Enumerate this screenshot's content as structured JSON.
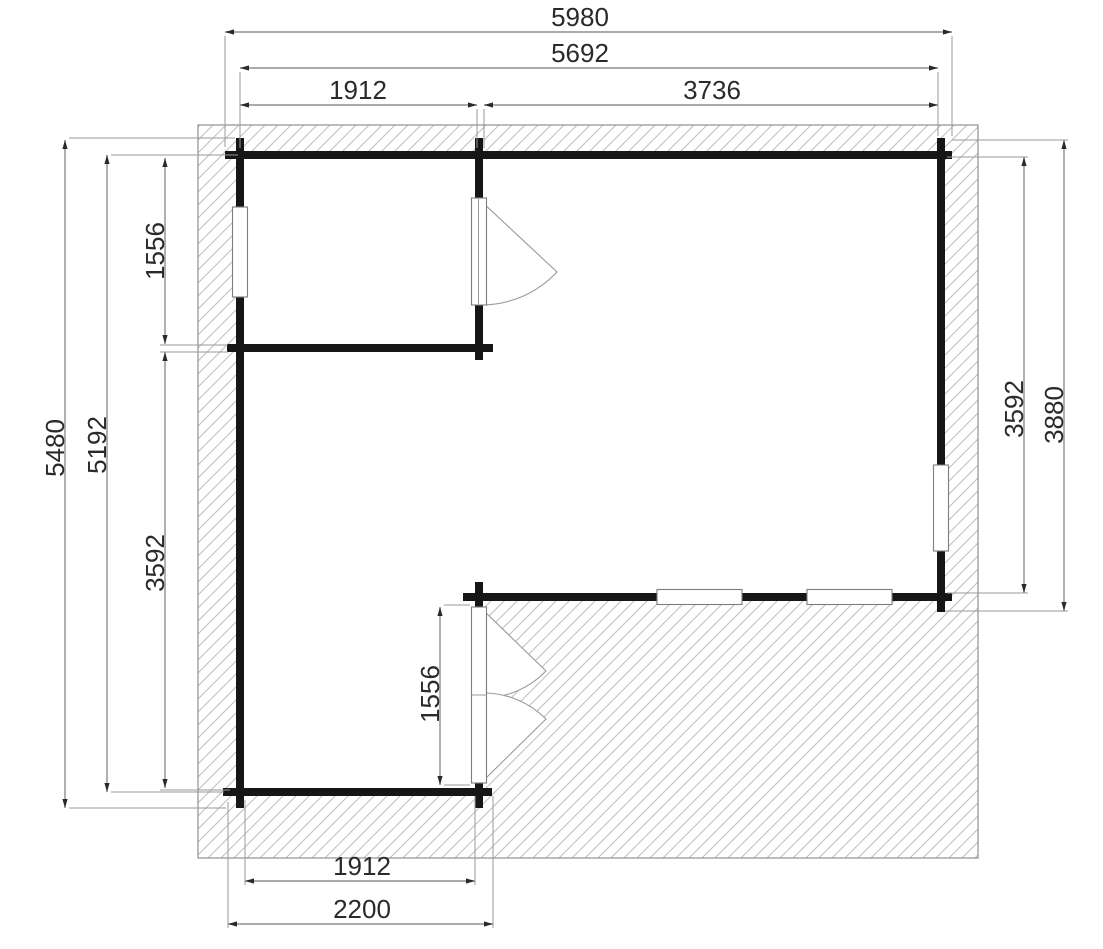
{
  "document": {
    "type": "architectural-floor-plan",
    "description": "Garden house floor plan with roof overhang, interior room partitions, windows, doors and terrace"
  },
  "canvas": {
    "width": 1103,
    "height": 949,
    "background": "#ffffff"
  },
  "style": {
    "wall_color": "#161616",
    "wall_thickness": 8,
    "hatch_line_color": "#bdbdbd",
    "hatch_spacing": 13,
    "hatch_border_color": "#8f8f8f",
    "dim_line_color": "#8f8f8f",
    "ext_line_color": "#9a9a9a",
    "arrow_color": "#2a2a2a",
    "text_color": "#2a2a2a",
    "font_size": 26,
    "window_fill": "#ffffff",
    "window_border": "#7d7d7d",
    "swing_color": "#9a9a9a"
  },
  "hatch_region": {
    "outer": {
      "x": 198,
      "y": 125,
      "w": 780,
      "h": 733
    },
    "interior_polygon": [
      [
        244,
        159
      ],
      [
        937,
        159
      ],
      [
        937,
        593
      ],
      [
        483,
        593
      ],
      [
        483,
        788
      ],
      [
        244,
        788
      ]
    ]
  },
  "walls": [
    {
      "name": "top-wall",
      "x1": 225,
      "y1": 155,
      "x2": 952,
      "y2": 155
    },
    {
      "name": "small-room-partition-wall",
      "x1": 227,
      "y1": 348,
      "x2": 493,
      "y2": 348
    },
    {
      "name": "middle-terrace-wall",
      "x1": 463,
      "y1": 597,
      "x2": 952,
      "y2": 597
    },
    {
      "name": "bottom-wall",
      "x1": 223,
      "y1": 792,
      "x2": 492,
      "y2": 792
    },
    {
      "name": "left-wall",
      "x1": 240,
      "y1": 138,
      "x2": 240,
      "y2": 808
    },
    {
      "name": "right-wall",
      "x1": 941,
      "y1": 138,
      "x2": 941,
      "y2": 612
    },
    {
      "name": "upper-partition-above-door",
      "x1": 479,
      "y1": 138,
      "x2": 479,
      "y2": 200
    },
    {
      "name": "upper-partition-below-door",
      "x1": 479,
      "y1": 303,
      "x2": 479,
      "y2": 360
    },
    {
      "name": "lower-partition-above-door",
      "x1": 479,
      "y1": 582,
      "x2": 479,
      "y2": 609
    },
    {
      "name": "lower-partition-below-door",
      "x1": 479,
      "y1": 781,
      "x2": 479,
      "y2": 808
    }
  ],
  "windows": [
    {
      "name": "window-left-wall",
      "x": 232.5,
      "y": 207,
      "w": 15,
      "h": 90
    },
    {
      "name": "window-right-wall",
      "x": 933.5,
      "y": 465,
      "w": 15,
      "h": 86
    },
    {
      "name": "window-middle-wall-1",
      "x": 657,
      "y": 589.5,
      "w": 85,
      "h": 15
    },
    {
      "name": "window-middle-wall-2",
      "x": 807,
      "y": 589.5,
      "w": 85,
      "h": 15
    }
  ],
  "doors": {
    "interior_door": {
      "name": "interior-single-door",
      "leaf": {
        "x": 471.5,
        "y": 198,
        "w": 15,
        "h": 107
      },
      "divider_x": 478.5,
      "swing_path": "M 481 201 L 557 272 A 104 104 0 0 1 482 305"
    },
    "terrace_double_door": {
      "name": "terrace-double-door",
      "leaf": {
        "x": 471.5,
        "y": 607,
        "w": 15,
        "h": 176
      },
      "mid_y": 695,
      "wedge_paths": [
        "M 483 610 L 546 671 A 88 88 0 0 1 484 698 Z",
        "M 483 781 L 546 719 A 88 88 0 0 0 484 693 Z"
      ]
    }
  },
  "dimensions": [
    {
      "name": "dim-overall-width",
      "label": "5980",
      "orient": "h",
      "line": [
        225,
        32,
        952,
        32
      ],
      "text": [
        580,
        26
      ],
      "ext": [
        [
          225,
          36,
          225,
          147
        ],
        [
          952,
          36,
          952,
          136
        ]
      ]
    },
    {
      "name": "dim-wall-width",
      "label": "5692",
      "orient": "h",
      "line": [
        240,
        68,
        938,
        68
      ],
      "text": [
        580,
        62
      ],
      "ext": [
        [
          240,
          72,
          240,
          148
        ],
        [
          938,
          72,
          938,
          136
        ]
      ]
    },
    {
      "name": "dim-room1-width",
      "label": "1912",
      "orient": "h",
      "line": [
        240,
        105,
        477,
        105
      ],
      "text": [
        358,
        99
      ],
      "ext": [
        [
          477,
          109,
          477,
          148
        ]
      ]
    },
    {
      "name": "dim-room2-width",
      "label": "3736",
      "orient": "h",
      "line": [
        484,
        105,
        938,
        105
      ],
      "text": [
        712,
        99
      ],
      "ext": [
        [
          484,
          109,
          484,
          148
        ]
      ]
    },
    {
      "name": "dim-overall-height",
      "label": "5480",
      "orient": "v",
      "line": [
        65,
        140,
        65,
        808
      ],
      "text": [
        64,
        448
      ],
      "ext": [
        [
          69,
          138,
          235,
          138
        ],
        [
          69,
          808,
          226,
          808
        ]
      ]
    },
    {
      "name": "dim-wall-height",
      "label": "5192",
      "orient": "v",
      "line": [
        107,
        155,
        107,
        792
      ],
      "text": [
        106,
        445
      ],
      "ext": [
        [
          111,
          155,
          238,
          155
        ],
        [
          111,
          792,
          224,
          792
        ]
      ]
    },
    {
      "name": "dim-room1-height",
      "label": "1556",
      "orient": "v",
      "line": [
        165,
        158,
        165,
        344
      ],
      "text": [
        164,
        251
      ],
      "ext": [
        [
          160,
          345,
          228,
          345
        ]
      ]
    },
    {
      "name": "dim-left-lower-height",
      "label": "3592",
      "orient": "v",
      "line": [
        165,
        352,
        165,
        788
      ],
      "text": [
        164,
        563
      ],
      "ext": [
        [
          160,
          352,
          228,
          352
        ],
        [
          160,
          790,
          230,
          790
        ]
      ]
    },
    {
      "name": "dim-right-inner-height",
      "label": "3592",
      "orient": "v",
      "line": [
        1024,
        157,
        1024,
        593
      ],
      "text": [
        1023,
        409
      ],
      "ext": [
        [
          947,
          157,
          1028,
          157
        ],
        [
          947,
          593,
          1028,
          593
        ]
      ]
    },
    {
      "name": "dim-right-outer-height",
      "label": "3880",
      "orient": "v",
      "line": [
        1064,
        140,
        1064,
        611
      ],
      "text": [
        1063,
        415
      ],
      "ext": [
        [
          952,
          140,
          1068,
          140
        ],
        [
          945,
          611,
          1068,
          611
        ]
      ]
    },
    {
      "name": "dim-bottom-room-width",
      "label": "1912",
      "orient": "h",
      "line": [
        245,
        881,
        475,
        881
      ],
      "text": [
        362,
        875
      ],
      "ext": [
        [
          245,
          800,
          245,
          885
        ],
        [
          475,
          796,
          475,
          885
        ]
      ]
    },
    {
      "name": "dim-bottom-overall-width",
      "label": "2200",
      "orient": "h",
      "line": [
        228,
        924,
        493,
        924
      ],
      "text": [
        362,
        918
      ],
      "ext": [
        [
          228,
          802,
          228,
          928
        ],
        [
          493,
          796,
          493,
          928
        ]
      ]
    },
    {
      "name": "dim-terrace-door-height",
      "label": "1556",
      "orient": "v",
      "line": [
        440,
        607,
        440,
        785
      ],
      "text": [
        439,
        694
      ],
      "ext": [
        [
          444,
          605,
          470,
          605
        ],
        [
          444,
          785,
          470,
          785
        ]
      ]
    }
  ]
}
